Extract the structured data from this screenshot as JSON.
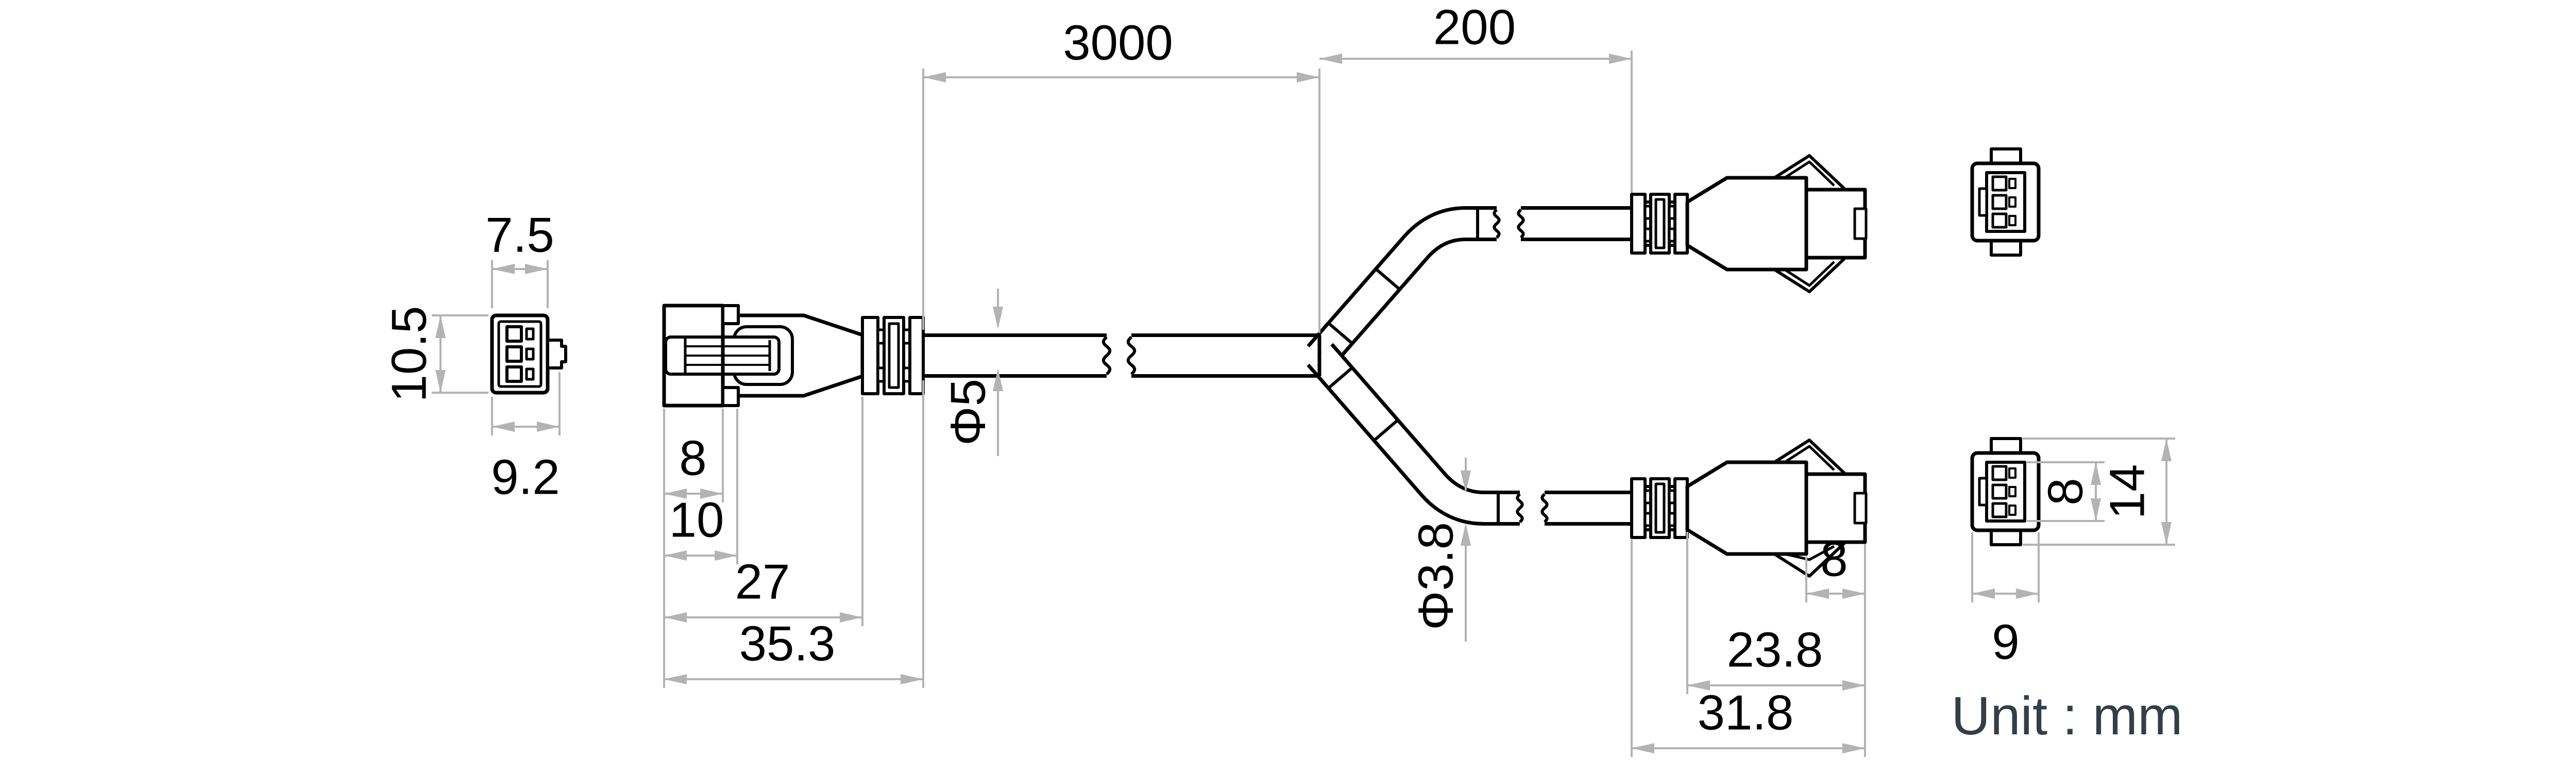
{
  "unit_label": "Unit : mm",
  "dimensions": {
    "front_left_width_top": "7.5",
    "front_left_height": "10.5",
    "front_left_width_bottom": "9.2",
    "plug_a_nose": "8",
    "plug_a_retainer": "10",
    "plug_a_body": "27",
    "plug_a_total": "35.3",
    "main_cable_length": "3000",
    "branch_length": "200",
    "main_cable_dia": "Φ5",
    "branch_cable_dia": "Φ3.8",
    "plug_b_nose": "8",
    "plug_b_body": "23.8",
    "plug_b_total": "31.8",
    "front_right_inner_height": "8",
    "front_right_total_height": "14",
    "front_right_width": "9"
  },
  "colors": {
    "line": "#000000",
    "dim": "#b3b3b3",
    "dim_text": "#000000",
    "unit_text": "#333e48",
    "background": "#ffffff"
  }
}
